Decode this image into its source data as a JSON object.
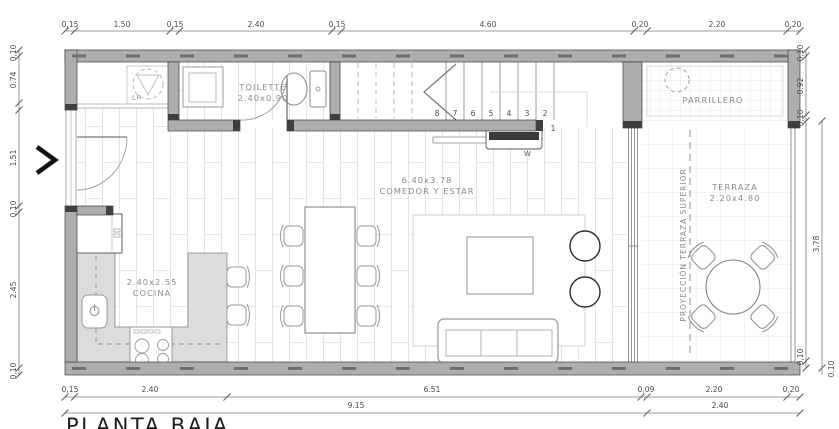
{
  "title": "PLANTA BAJA",
  "rooms": {
    "toilette": {
      "name": "TOILETTE",
      "size": "2.40x0.90"
    },
    "cocina": {
      "name": "COCINA",
      "size": "2.40x2.55"
    },
    "comedor": {
      "name": "COMEDOR Y ESTAR",
      "size": "6.40x3.78"
    },
    "parrillero": {
      "name": "PARRILLERO"
    },
    "terraza": {
      "name": "TERRAZA",
      "size": "2.20x4.80"
    },
    "proyeccion_label": "PROYECCIÓN TERRAZA SUPERIOR",
    "laundry_label": "LR",
    "stair_window_label": "W"
  },
  "stair_steps": [
    "8",
    "7",
    "6",
    "5",
    "4",
    "3",
    "2",
    "1"
  ],
  "dims": {
    "top": [
      "0,15",
      "1.50",
      "0,15",
      "2.40",
      "0,15",
      "4.60",
      "0,20",
      "2.20",
      "0,20"
    ],
    "left": [
      "0,10",
      "0.74",
      "1.51",
      "0,10",
      "2.45",
      "0,10"
    ],
    "right": [
      "0,10",
      "0.92",
      "0,10",
      "3.78",
      "0,10",
      "0.10"
    ],
    "bottom1": [
      "0,15",
      "2.40",
      "6.51",
      "0,09",
      "2.20",
      "0,20"
    ],
    "bottom2": [
      "9.15",
      "2.40"
    ]
  },
  "colors": {
    "wall": "#aeaeae",
    "wall_cap": "#3f3f3f",
    "counter": "#dcdcdc",
    "floor_line": "#e3e3e3",
    "furniture_line": "#999999",
    "dim_text": "#4a4a4a",
    "room_text": "#8a8a8a",
    "title_text": "#1d1d1d",
    "dark_unit": "#3a3a3a"
  }
}
